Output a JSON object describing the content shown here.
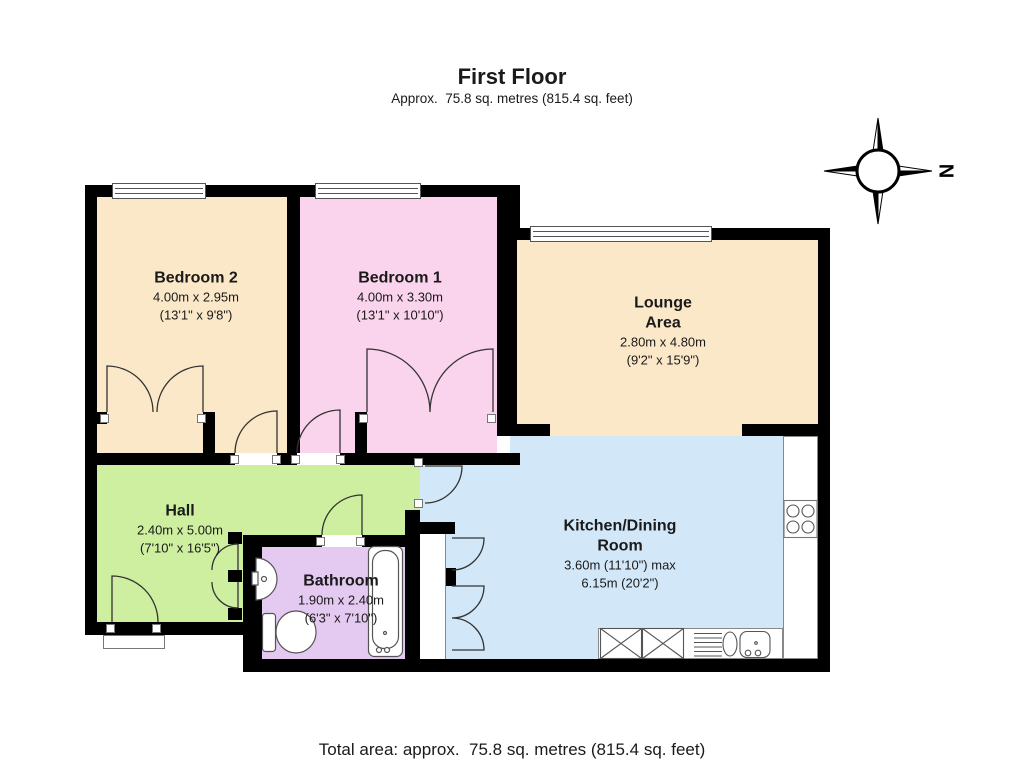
{
  "header": {
    "title": "First Floor",
    "subtitle": "Approx.  75.8 sq. metres (815.4 sq. feet)"
  },
  "footer": {
    "total_area": "Total area: approx.  75.8 sq. metres (815.4 sq. feet)"
  },
  "compass": {
    "label": "N"
  },
  "rooms": [
    {
      "id": "bedroom-2",
      "name": "Bedroom 2",
      "metric": "4.00m x 2.95m",
      "imperial": "(13'1\" x 9'8\")",
      "color": "#fbe8c8"
    },
    {
      "id": "bedroom-1",
      "name": "Bedroom 1",
      "metric": "4.00m x 3.30m",
      "imperial": "(13'1\" x 10'10\")",
      "color": "#fad3ec"
    },
    {
      "id": "lounge-area",
      "name": "Lounge\nArea",
      "metric": "2.80m x 4.80m",
      "imperial": "(9'2\" x 15'9\")",
      "color": "#fbe8c8"
    },
    {
      "id": "hall",
      "name": "Hall",
      "metric": "2.40m x 5.00m",
      "imperial": "(7'10\" x 16'5\")",
      "color": "#cdef9f"
    },
    {
      "id": "bathroom",
      "name": "Bathroom",
      "metric": "1.90m x 2.40m",
      "imperial": "(6'3\" x 7'10\")",
      "color": "#e4c9f1"
    },
    {
      "id": "kitchen-dining-room",
      "name": "Kitchen/Dining\nRoom",
      "metric": "3.60m (11'10\") max",
      "imperial": "6.15m (20'2\")",
      "color": "#d2e8f8"
    }
  ],
  "colors": {
    "wall": "#000000",
    "fixture_outline": "#555555",
    "door_arc": "#333333"
  }
}
